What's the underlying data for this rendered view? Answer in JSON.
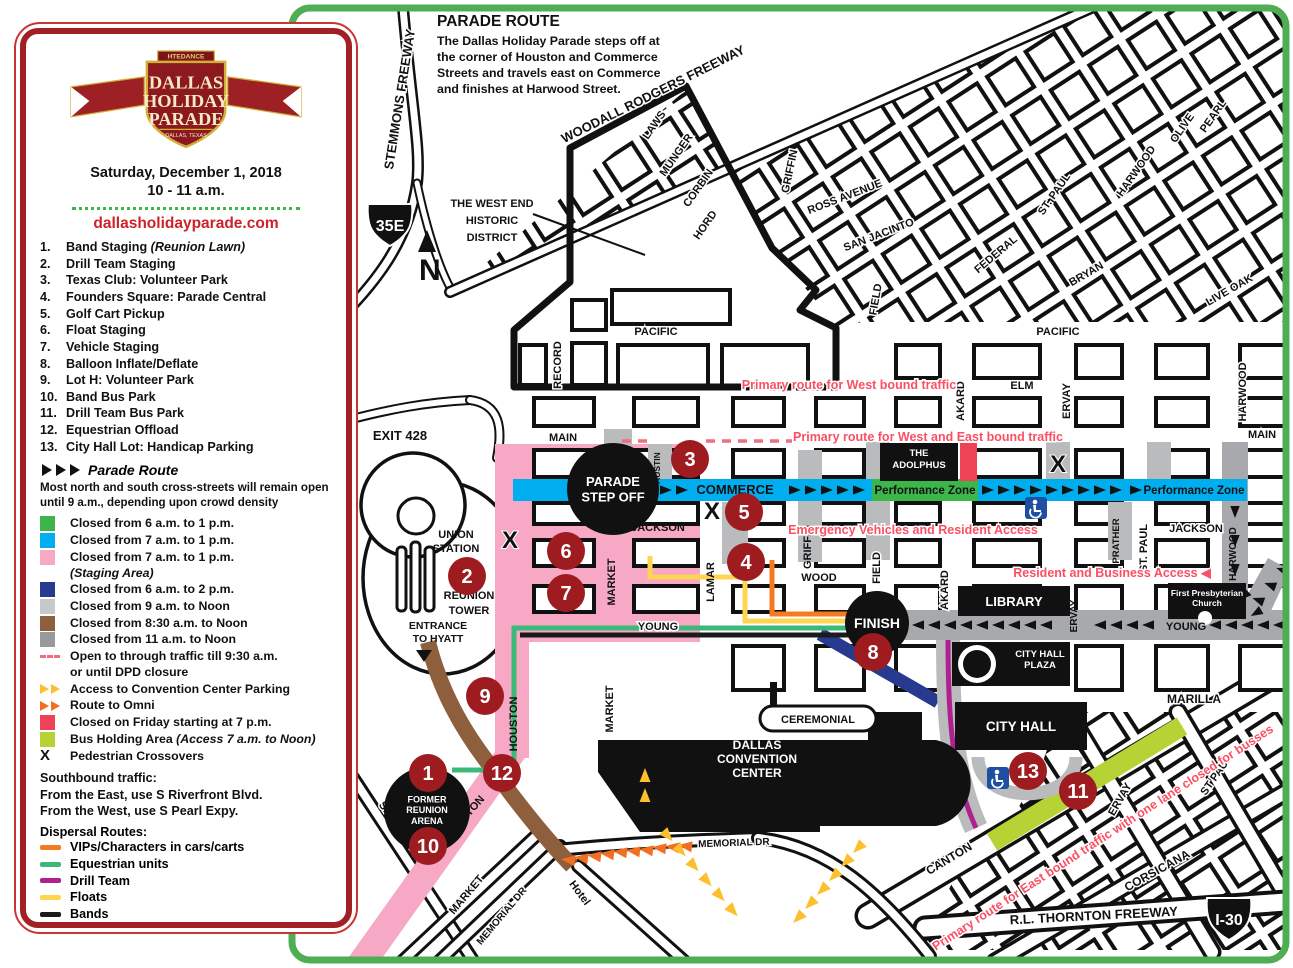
{
  "colors": {
    "green": "#3cb54a",
    "cyan": "#00aeef",
    "pink": "#f6a8c5",
    "navy": "#283a8f",
    "lightgray": "#c6c8ca",
    "brown": "#8d5f3d",
    "gray": "#97999b",
    "dashred": "#f26d7d",
    "yellow_tri": "#fdbf2d",
    "orange_tri": "#f26f22",
    "red": "#ee4256",
    "yellowgreen": "#b5d334",
    "vip_orange": "#f47920",
    "equestrian_green": "#3cb878",
    "drill_magenta": "#b0208e",
    "floats_yellow": "#ffd451",
    "bands_black": "#1a1a1a",
    "red_text": "#fb4f63",
    "marker_red": "#9e1b20",
    "border_green": "#4fae54",
    "sidebar_red": "#a21f24"
  },
  "sidebar": {
    "logo": {
      "presents1": "HTEDANCE",
      "presents2": "PRESENTS",
      "title1": "DALLAS",
      "title2": "HOLIDAY",
      "title3": "PARADE",
      "subtitle": "DALLAS, TEXAS"
    },
    "date_line1": "Saturday, December 1, 2018",
    "date_line2": "10 - 11 a.m.",
    "website": "dallasholidayparade.com",
    "numbered_items": [
      {
        "num": "1.",
        "text": "Band Staging ",
        "italic": "(Reunion Lawn)"
      },
      {
        "num": "2.",
        "text": "Drill Team Staging"
      },
      {
        "num": "3.",
        "text": "Texas Club: Volunteer Park"
      },
      {
        "num": "4.",
        "text": "Founders Square: Parade Central"
      },
      {
        "num": "5.",
        "text": "Golf Cart Pickup"
      },
      {
        "num": "6.",
        "text": "Float Staging"
      },
      {
        "num": "7.",
        "text": "Vehicle Staging"
      },
      {
        "num": "8.",
        "text": "Balloon Inflate/Deflate"
      },
      {
        "num": "9.",
        "text": "Lot H: Volunteer Park"
      },
      {
        "num": "10.",
        "text": "Band Bus Park"
      },
      {
        "num": "11.",
        "text": "Drill Team Bus Park"
      },
      {
        "num": "12.",
        "text": "Equestrian Offload"
      },
      {
        "num": "13.",
        "text": "City Hall Lot: Handicap Parking"
      }
    ],
    "parade_route_label": "Parade Route",
    "note_line1": "Most north and south cross-streets will remain open",
    "note_line2": "until 9 a.m., depending upon crowd density",
    "closures": [
      {
        "type": "sq",
        "color": "#3cb54a",
        "label": "Closed from 6 a.m. to 1 p.m."
      },
      {
        "type": "sq",
        "color": "#00aeef",
        "label": "Closed from 7 a.m. to 1 p.m."
      },
      {
        "type": "sq",
        "color": "#f6a8c5",
        "label": "Closed from 7 a.m. to 1 p.m.",
        "label2": "(Staging Area)",
        "italic2": true
      },
      {
        "type": "sq",
        "color": "#283a8f",
        "label": "Closed from 6 a.m. to 2 p.m."
      },
      {
        "type": "sq",
        "color": "#c6c8ca",
        "label": "Closed from 9 a.m. to Noon"
      },
      {
        "type": "sq",
        "color": "#8d5f3d",
        "label": "Closed from 8:30 a.m. to Noon"
      },
      {
        "type": "sq",
        "color": "#97999b",
        "label": "Closed from 11 a.m. to Noon"
      },
      {
        "type": "dash",
        "color": "#f26d7d",
        "label": "Open to through traffic till 9:30 a.m.",
        "label2": "or until DPD closure",
        "italic2": false
      },
      {
        "type": "tri2",
        "color": "#fdbf2d",
        "label": "Access to Convention Center Parking"
      },
      {
        "type": "tri2",
        "color": "#f26f22",
        "label": "Route to Omni"
      },
      {
        "type": "sq",
        "color": "#ee4256",
        "label": "Closed on Friday starting at 7 p.m."
      },
      {
        "type": "sq",
        "color": "#b5d334",
        "label": "Bus Holding Area ",
        "inline_italic": "(Access 7 a.m. to Noon)"
      },
      {
        "type": "x",
        "color": "#111",
        "label": "Pedestrian Crossovers"
      }
    ],
    "southbound_line1": "Southbound traffic:",
    "southbound_line2": "From the East, use S Riverfront Blvd.",
    "southbound_line3": "From the West, use S Pearl Expy.",
    "dispersal": {
      "header": "Dispersal Routes:",
      "items": [
        {
          "color": "#f47920",
          "label": "VIPs/Characters in cars/carts"
        },
        {
          "color": "#3cb878",
          "label": "Equestrian units"
        },
        {
          "color": "#b0208e",
          "label": "Drill Team"
        },
        {
          "color": "#ffd451",
          "label": "Floats"
        },
        {
          "color": "#1a1a1a",
          "label": "Bands"
        }
      ]
    }
  },
  "map": {
    "header": {
      "title": "PARADE ROUTE",
      "lines": [
        "The Dallas Holiday Parade steps off at",
        "the corner of Houston and Commerce",
        "Streets and travels east on Commerce",
        "and finishes at Harwood Street."
      ]
    },
    "compass": {
      "label": "N",
      "x": 419,
      "y": 280
    },
    "shields": [
      {
        "label": "35E",
        "x": 390,
        "y": 218
      },
      {
        "label": "I-30",
        "x": 1229,
        "y": 912
      }
    ],
    "street_labels": [
      {
        "t": "STEMMONS FREEWAY",
        "x": 404,
        "y": 100,
        "r": -81,
        "s": 13
      },
      {
        "t": "WOODALL RODGERS FREEWAY",
        "x": 655,
        "y": 98,
        "r": -26.5,
        "s": 13
      },
      {
        "t": "LAWS",
        "x": 657,
        "y": 127,
        "r": -55,
        "s": 11
      },
      {
        "t": "MUNGER",
        "x": 679,
        "y": 157,
        "r": -55,
        "s": 11
      },
      {
        "t": "CORBIN",
        "x": 701,
        "y": 190,
        "r": -55,
        "s": 11
      },
      {
        "t": "HORD",
        "x": 708,
        "y": 227,
        "r": -55,
        "s": 11
      },
      {
        "t": "GRIFFIN",
        "x": 793,
        "y": 172,
        "r": -78,
        "s": 11
      },
      {
        "t": "ROSS AVENUE",
        "x": 846,
        "y": 200,
        "r": -21,
        "s": 11
      },
      {
        "t": "SAN JACINTO",
        "x": 880,
        "y": 238,
        "r": -21,
        "s": 11
      },
      {
        "t": "FIELD",
        "x": 879,
        "y": 300,
        "r": -80,
        "s": 11
      },
      {
        "t": "FEDERAL",
        "x": 998,
        "y": 257,
        "r": -40,
        "s": 11
      },
      {
        "t": "BRYAN",
        "x": 1088,
        "y": 277,
        "r": -30,
        "s": 11
      },
      {
        "t": "LIVE OAK",
        "x": 1231,
        "y": 293,
        "r": -30,
        "s": 11
      },
      {
        "t": "ST. PAUL",
        "x": 1057,
        "y": 196,
        "r": -55,
        "s": 11
      },
      {
        "t": "HARWOOD",
        "x": 1139,
        "y": 173,
        "r": -55,
        "s": 11
      },
      {
        "t": "OLIVE",
        "x": 1185,
        "y": 130,
        "r": -55,
        "s": 11
      },
      {
        "t": "PEARL",
        "x": 1216,
        "y": 118,
        "r": -55,
        "s": 11
      },
      {
        "t": "RECORD",
        "x": 561,
        "y": 365,
        "r": -90,
        "s": 11
      },
      {
        "t": "PACIFIC",
        "x": 656,
        "y": 335,
        "r": 0,
        "s": 11
      },
      {
        "t": "PACIFIC",
        "x": 1058,
        "y": 335,
        "r": 0,
        "s": 11
      },
      {
        "t": "MAIN",
        "x": 563,
        "y": 441,
        "r": 0,
        "s": 11
      },
      {
        "t": "MAIN",
        "x": 1262,
        "y": 438,
        "r": 0,
        "s": 11
      },
      {
        "t": "ELM",
        "x": 1022,
        "y": 389,
        "r": 0,
        "s": 11
      },
      {
        "t": "AKARD",
        "x": 964,
        "y": 401,
        "r": -90,
        "s": 11
      },
      {
        "t": "ERVAY",
        "x": 1070,
        "y": 401,
        "r": -90,
        "s": 11
      },
      {
        "t": "HARWOOD",
        "x": 1246,
        "y": 392,
        "r": -90,
        "s": 11
      },
      {
        "t": "AUSTIN",
        "x": 660,
        "y": 468,
        "r": -90,
        "s": 8.5,
        "h": 0
      },
      {
        "t": "COMMERCE",
        "x": 735,
        "y": 494,
        "r": 0,
        "s": 13,
        "h": 0
      },
      {
        "t": "Performance Zone",
        "x": 925,
        "y": 494,
        "r": 0,
        "s": 11.5,
        "h": 0
      },
      {
        "t": "Performance Zone",
        "x": 1194,
        "y": 494,
        "r": 0,
        "s": 11.5,
        "h": 0
      },
      {
        "t": "JACKSON",
        "x": 658,
        "y": 531,
        "r": 0,
        "s": 11,
        "h": 0
      },
      {
        "t": "JACKSON",
        "x": 1196,
        "y": 532,
        "r": 0,
        "s": 11
      },
      {
        "t": "MARKET",
        "x": 615,
        "y": 582,
        "r": -90,
        "s": 11,
        "h": 0
      },
      {
        "t": "LAMAR",
        "x": 714,
        "y": 582,
        "r": -90,
        "s": 11,
        "h": 0
      },
      {
        "t": "GRIFFIN",
        "x": 811,
        "y": 547,
        "r": -90,
        "s": 11,
        "h": 0
      },
      {
        "t": "FIELD",
        "x": 880,
        "y": 568,
        "r": -90,
        "s": 11
      },
      {
        "t": "AKARD",
        "x": 948,
        "y": 590,
        "r": -90,
        "s": 11
      },
      {
        "t": "WOOD",
        "x": 819,
        "y": 581,
        "r": 0,
        "s": 11
      },
      {
        "t": "PRATHER",
        "x": 1119,
        "y": 541,
        "r": -90,
        "s": 9.5,
        "h": 0
      },
      {
        "t": "ST. PAUL",
        "x": 1147,
        "y": 548,
        "r": -90,
        "s": 11
      },
      {
        "t": "YOUNG",
        "x": 658,
        "y": 630,
        "r": 0,
        "s": 11
      },
      {
        "t": "YOUNG",
        "x": 1186,
        "y": 630,
        "r": 0,
        "s": 11,
        "h": 0
      },
      {
        "t": "ERVAY",
        "x": 1077,
        "y": 616,
        "r": -90,
        "s": 10,
        "h": 0
      },
      {
        "t": "HARWOOD",
        "x": 1236,
        "y": 554,
        "r": -90,
        "s": 10,
        "h": 0
      },
      {
        "t": "MARILLA",
        "x": 1194,
        "y": 703,
        "r": 0,
        "s": 12
      },
      {
        "t": "MARKET",
        "x": 613,
        "y": 709,
        "r": -90,
        "s": 11
      },
      {
        "t": "HOUSTON",
        "x": 517,
        "y": 724,
        "r": -90,
        "s": 11,
        "h": 0
      },
      {
        "t": "Hotel",
        "x": 459,
        "y": 753,
        "r": 62,
        "s": 11,
        "c": "#fff",
        "h": 0
      },
      {
        "t": "HOUSTON",
        "x": 467,
        "y": 820,
        "r": -49,
        "s": 11,
        "h": 0
      },
      {
        "t": "SPORTS",
        "x": 392,
        "y": 823,
        "r": 53,
        "s": 11
      },
      {
        "t": "MARKET",
        "x": 469,
        "y": 897,
        "r": -50,
        "s": 11
      },
      {
        "t": "MEMORIAL DR",
        "x": 504,
        "y": 918,
        "r": -50,
        "s": 10
      },
      {
        "t": "MEMORIAL DR",
        "x": 734,
        "y": 846,
        "r": -2,
        "s": 10
      },
      {
        "t": "Hotel",
        "x": 577,
        "y": 895,
        "r": 53,
        "s": 11
      },
      {
        "t": "CANTON",
        "x": 951,
        "y": 862,
        "r": -31,
        "s": 12
      },
      {
        "t": "CORSICANA",
        "x": 1159,
        "y": 874,
        "r": -29,
        "s": 12
      },
      {
        "t": "ERVAY",
        "x": 1123,
        "y": 801,
        "r": -60,
        "s": 11
      },
      {
        "t": "ST PAUL",
        "x": 1219,
        "y": 777,
        "r": -55,
        "s": 11
      },
      {
        "t": "R.L. THORNTON FREEWAY",
        "x": 1094,
        "y": 920,
        "r": -3,
        "s": 13
      },
      {
        "t": "EXIT 428",
        "x": 400,
        "y": 440,
        "r": 0,
        "s": 13
      }
    ],
    "red_notes": [
      {
        "t": "Primary route for West bound traffic",
        "x": 849,
        "y": 389,
        "r": 0
      },
      {
        "t": "Primary route for West and East bound traffic",
        "x": 928,
        "y": 441,
        "r": 0
      },
      {
        "t": "Emergency Vehicles and Resident Access",
        "x": 913,
        "y": 534,
        "r": 0
      },
      {
        "t": "Resident and Business Access ◀",
        "x": 1112,
        "y": 577,
        "r": 0
      },
      {
        "t": "Primary route for East bound traffic with one lane closed for busses",
        "x": 1105,
        "y": 841,
        "r": -33
      }
    ],
    "area_labels": [
      {
        "lines": [
          "THE WEST END",
          "HISTORIC",
          "DISTRICT"
        ],
        "x": 492,
        "y": 207,
        "s": 11,
        "st": 17
      },
      {
        "lines": [
          "UNION",
          "STATION"
        ],
        "x": 456,
        "y": 538,
        "s": 11,
        "st": 14
      },
      {
        "lines": [
          "REUNION",
          "TOWER"
        ],
        "x": 469,
        "y": 599,
        "s": 11,
        "st": 15
      },
      {
        "lines": [
          "ENTRANCE",
          "TO HYATT"
        ],
        "x": 438,
        "y": 629,
        "s": 10.5,
        "st": 13
      },
      {
        "lines": [
          "CEREMONIAL"
        ],
        "x": 818,
        "y": 723,
        "s": 11,
        "st": 0
      },
      {
        "lines": [
          "THE",
          "ADOLPHUS"
        ],
        "x": 919,
        "y": 456,
        "s": 9.5,
        "st": 12,
        "c": "#fff"
      },
      {
        "lines": [
          "LIBRARY"
        ],
        "x": 1014,
        "y": 606,
        "s": 13,
        "st": 0,
        "c": "#fff"
      },
      {
        "lines": [
          "CITY HALL",
          "PLAZA"
        ],
        "x": 1040,
        "y": 657,
        "s": 9.5,
        "st": 11,
        "c": "#fff"
      },
      {
        "lines": [
          "CITY HALL"
        ],
        "x": 1021,
        "y": 731,
        "s": 13.5,
        "st": 0,
        "c": "#fff"
      },
      {
        "lines": [
          "First Presbyterian",
          "Church"
        ],
        "x": 1207,
        "y": 596,
        "s": 8.5,
        "st": 10,
        "c": "#fff"
      },
      {
        "lines": [
          "DALLAS",
          "CONVENTION",
          "CENTER"
        ],
        "x": 757,
        "y": 749,
        "s": 12,
        "st": 14,
        "c": "#fff"
      }
    ],
    "black_circles": [
      {
        "lines": [
          "PARADE",
          "STEP OFF"
        ],
        "x": 613,
        "y": 489,
        "radius": 46,
        "fs": 13
      },
      {
        "lines": [
          "FINISH"
        ],
        "x": 877,
        "y": 623,
        "radius": 32,
        "fs": 14
      },
      {
        "lines": [
          "FORMER",
          "REUNION",
          "ARENA"
        ],
        "x": 427,
        "y": 810,
        "radius": 43,
        "fs": 9
      }
    ],
    "numbered_markers": [
      {
        "n": "1",
        "x": 428,
        "y": 773
      },
      {
        "n": "2",
        "x": 467,
        "y": 576
      },
      {
        "n": "3",
        "x": 690,
        "y": 459
      },
      {
        "n": "4",
        "x": 746,
        "y": 562
      },
      {
        "n": "5",
        "x": 744,
        "y": 512
      },
      {
        "n": "6",
        "x": 566,
        "y": 551
      },
      {
        "n": "7",
        "x": 566,
        "y": 593
      },
      {
        "n": "8",
        "x": 873,
        "y": 652
      },
      {
        "n": "9",
        "x": 485,
        "y": 696
      },
      {
        "n": "10",
        "x": 428,
        "y": 846
      },
      {
        "n": "11",
        "x": 1078,
        "y": 791
      },
      {
        "n": "12",
        "x": 502,
        "y": 773
      },
      {
        "n": "13",
        "x": 1028,
        "y": 771
      }
    ],
    "crossovers": [
      {
        "x": 510,
        "y": 548
      },
      {
        "x": 712,
        "y": 519
      },
      {
        "x": 1058,
        "y": 472
      }
    ]
  }
}
